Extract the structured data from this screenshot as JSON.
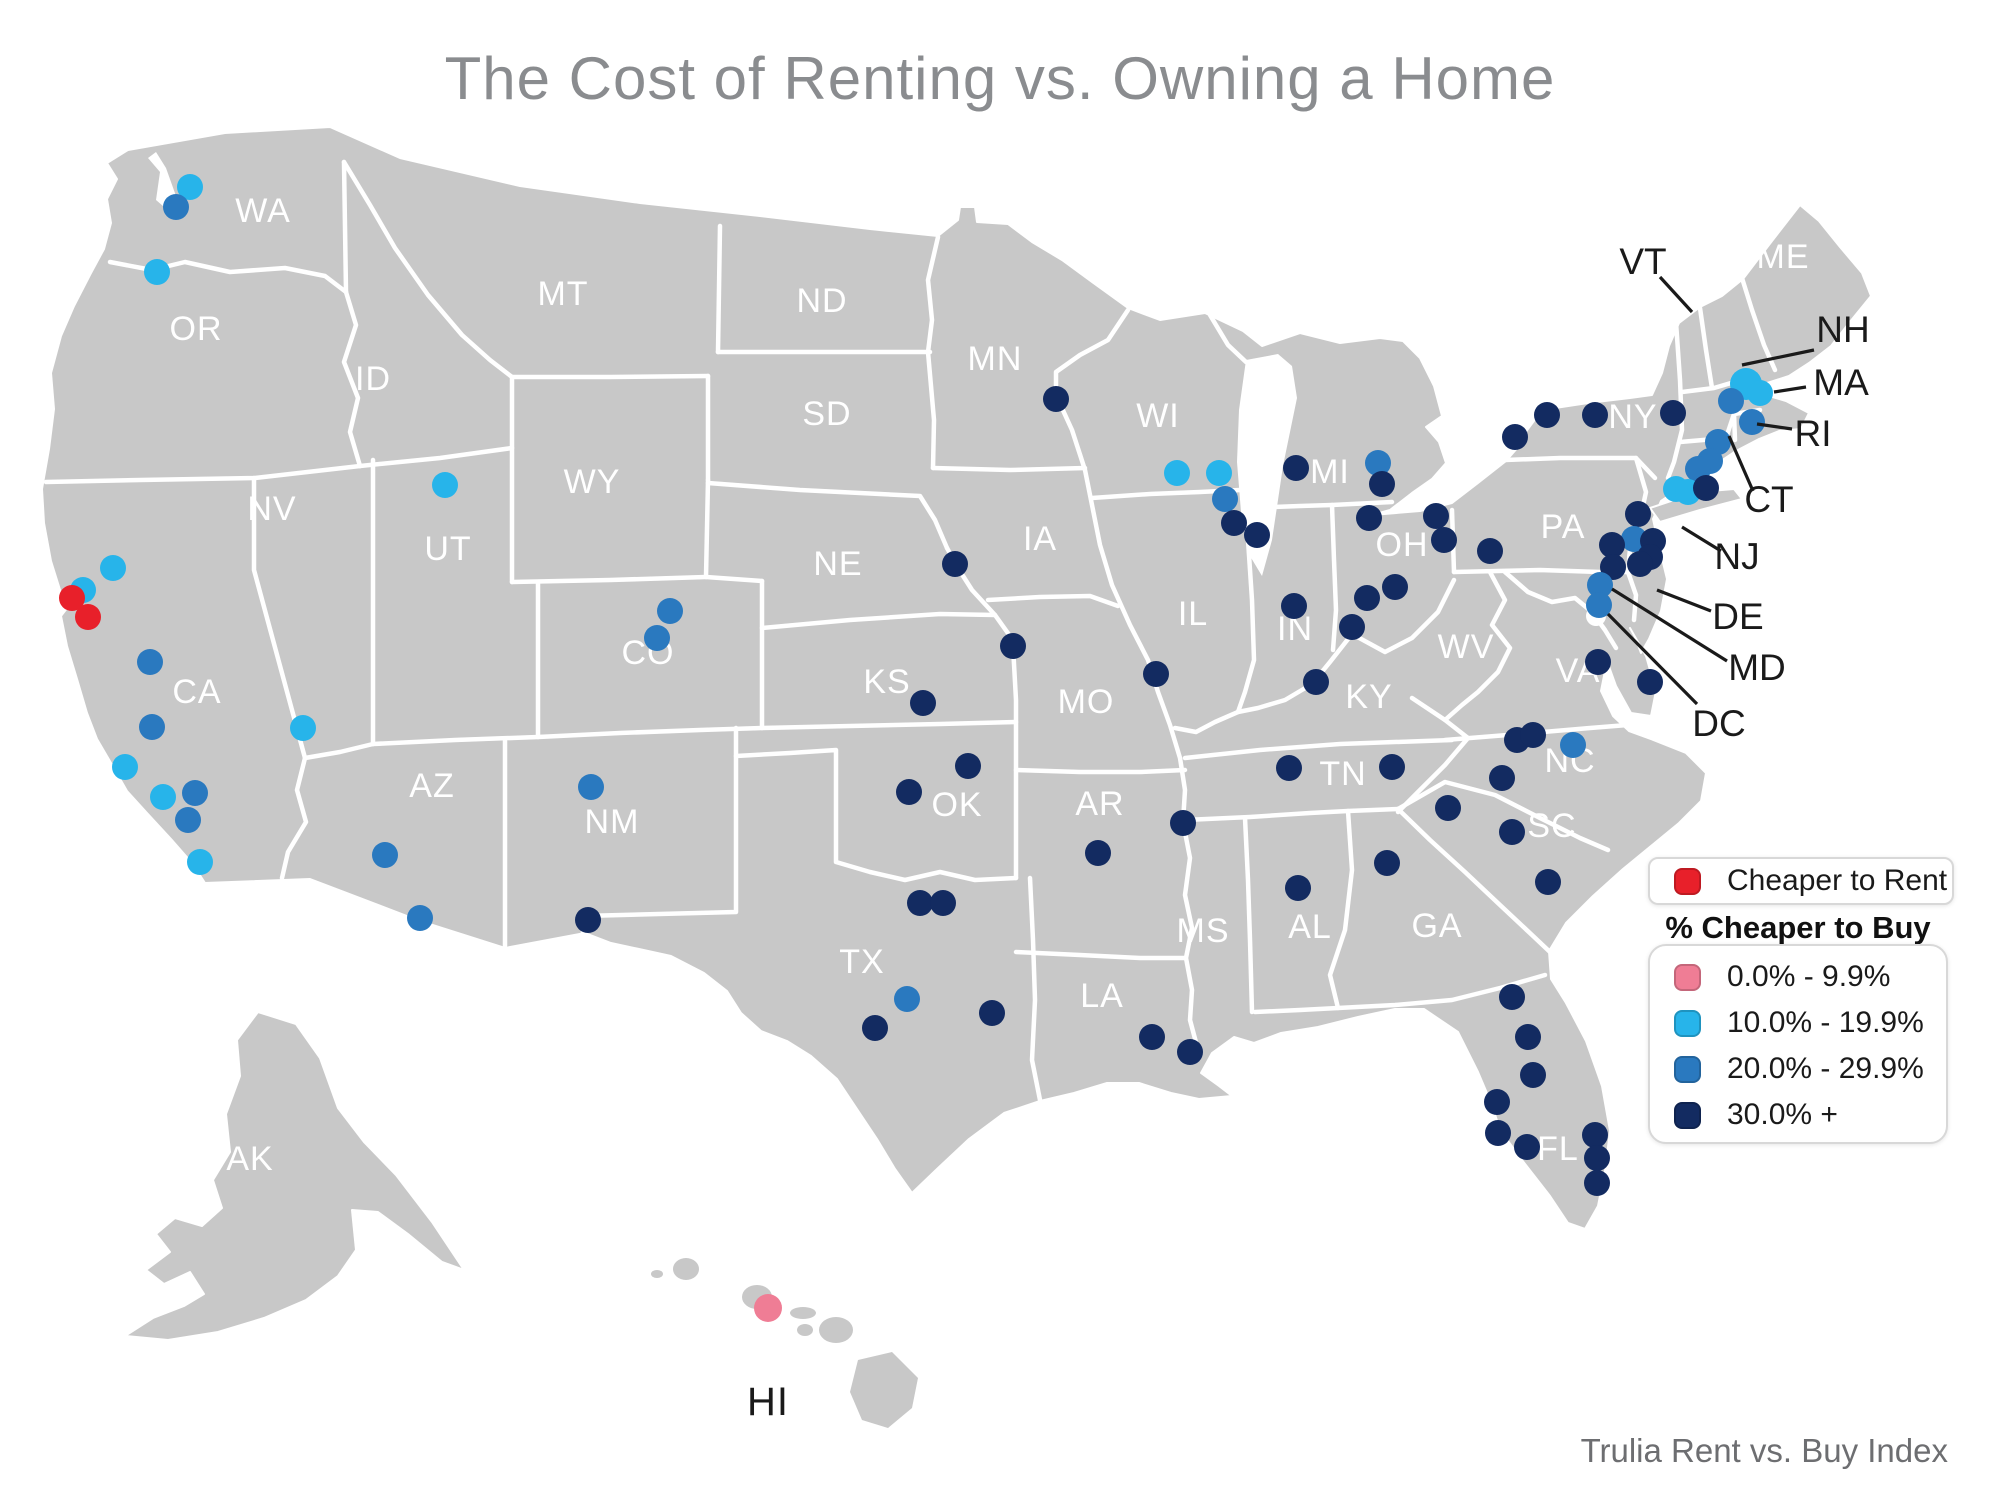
{
  "title": "The Cost of Renting vs. Owning a Home",
  "attribution": "Trulia Rent vs. Buy Index",
  "colors": {
    "rent": "#e8202a",
    "p0": "#ef7d95",
    "p10": "#27b4ea",
    "p20": "#2a79bf",
    "p30": "#132b61",
    "land": "#c8c8c8",
    "border": "#ffffff",
    "state_label": "#ffffff",
    "callout": "#1a1a1a",
    "title": "#8a8c8f",
    "attribution": "#6d6e71"
  },
  "legend": {
    "rent": {
      "label": "Cheaper to Rent",
      "color_key": "rent"
    },
    "buy_heading": "% Cheaper to Buy",
    "buy_items": [
      {
        "label": "0.0% - 9.9%",
        "color_key": "p0"
      },
      {
        "label": "10.0% - 19.9%",
        "color_key": "p10"
      },
      {
        "label": "20.0% - 29.9%",
        "color_key": "p20"
      },
      {
        "label": "30.0% +",
        "color_key": "p30"
      }
    ]
  },
  "chart_data": {
    "type": "scatter",
    "title": "The Cost of Renting vs. Owning a Home",
    "note": "Dot map of U.S. metros colored by Trulia Rent vs. Buy Index category",
    "categories": [
      "Cheaper to Rent",
      "0.0% - 9.9%",
      "10.0% - 19.9%",
      "20.0% - 29.9%",
      "30.0% +"
    ],
    "category_counts": {
      "cheaper_to_rent": 2,
      "buy_0_9.9": 1,
      "buy_10_19.9": 15,
      "buy_20_29.9": 22,
      "buy_30_plus": 61
    },
    "legend_position": "right"
  },
  "map": {
    "state_labels": [
      {
        "text": "WA",
        "x": 263,
        "y": 222
      },
      {
        "text": "OR",
        "x": 196,
        "y": 340
      },
      {
        "text": "CA",
        "x": 197,
        "y": 703
      },
      {
        "text": "NV",
        "x": 272,
        "y": 520
      },
      {
        "text": "ID",
        "x": 373,
        "y": 390
      },
      {
        "text": "UT",
        "x": 448,
        "y": 560
      },
      {
        "text": "AZ",
        "x": 432,
        "y": 797
      },
      {
        "text": "MT",
        "x": 563,
        "y": 305
      },
      {
        "text": "WY",
        "x": 592,
        "y": 493
      },
      {
        "text": "CO",
        "x": 648,
        "y": 664
      },
      {
        "text": "NM",
        "x": 612,
        "y": 833
      },
      {
        "text": "ND",
        "x": 822,
        "y": 312
      },
      {
        "text": "SD",
        "x": 827,
        "y": 425
      },
      {
        "text": "NE",
        "x": 838,
        "y": 575
      },
      {
        "text": "KS",
        "x": 887,
        "y": 693
      },
      {
        "text": "OK",
        "x": 957,
        "y": 816
      },
      {
        "text": "TX",
        "x": 862,
        "y": 973
      },
      {
        "text": "MN",
        "x": 995,
        "y": 370
      },
      {
        "text": "IA",
        "x": 1040,
        "y": 550
      },
      {
        "text": "MO",
        "x": 1086,
        "y": 713
      },
      {
        "text": "AR",
        "x": 1100,
        "y": 815
      },
      {
        "text": "LA",
        "x": 1102,
        "y": 1007
      },
      {
        "text": "WI",
        "x": 1158,
        "y": 427
      },
      {
        "text": "IL",
        "x": 1193,
        "y": 625
      },
      {
        "text": "IN",
        "x": 1295,
        "y": 640
      },
      {
        "text": "MI",
        "x": 1330,
        "y": 483
      },
      {
        "text": "OH",
        "x": 1402,
        "y": 556
      },
      {
        "text": "KY",
        "x": 1369,
        "y": 708
      },
      {
        "text": "TN",
        "x": 1343,
        "y": 785
      },
      {
        "text": "MS",
        "x": 1203,
        "y": 942
      },
      {
        "text": "AL",
        "x": 1310,
        "y": 938
      },
      {
        "text": "GA",
        "x": 1437,
        "y": 937
      },
      {
        "text": "FL",
        "x": 1558,
        "y": 1160
      },
      {
        "text": "WV",
        "x": 1466,
        "y": 658
      },
      {
        "text": "VA",
        "x": 1578,
        "y": 682
      },
      {
        "text": "NC",
        "x": 1570,
        "y": 772
      },
      {
        "text": "SC",
        "x": 1552,
        "y": 837
      },
      {
        "text": "PA",
        "x": 1563,
        "y": 538
      },
      {
        "text": "NY",
        "x": 1633,
        "y": 428
      },
      {
        "text": "ME",
        "x": 1783,
        "y": 268
      },
      {
        "text": "AK",
        "x": 250,
        "y": 1170
      },
      {
        "text": "HI",
        "x": 768,
        "y": 1415,
        "dark": true,
        "size": 40
      }
    ],
    "callouts": [
      {
        "text": "VT",
        "x": 1643,
        "y": 262,
        "line": [
          1660,
          277,
          1692,
          312
        ]
      },
      {
        "text": "NH",
        "x": 1843,
        "y": 330,
        "line": [
          1814,
          350,
          1742,
          365
        ]
      },
      {
        "text": "MA",
        "x": 1841,
        "y": 383,
        "line": [
          1806,
          387,
          1774,
          392
        ]
      },
      {
        "text": "RI",
        "x": 1813,
        "y": 434,
        "line": [
          1792,
          429,
          1757,
          424
        ]
      },
      {
        "text": "CT",
        "x": 1769,
        "y": 500,
        "line": [
          1753,
          491,
          1729,
          436
        ]
      },
      {
        "text": "NJ",
        "x": 1737,
        "y": 557,
        "line": [
          1721,
          551,
          1682,
          527
        ]
      },
      {
        "text": "DE",
        "x": 1738,
        "y": 617,
        "line": [
          1711,
          611,
          1657,
          590
        ]
      },
      {
        "text": "MD",
        "x": 1757,
        "y": 668,
        "line": [
          1727,
          661,
          1612,
          589
        ]
      },
      {
        "text": "DC",
        "x": 1719,
        "y": 724,
        "line": [
          1697,
          704,
          1608,
          614
        ]
      }
    ],
    "cities": [
      {
        "x": 190,
        "y": 187,
        "cat": "p10"
      },
      {
        "x": 176,
        "y": 207,
        "cat": "p20"
      },
      {
        "x": 157,
        "y": 272,
        "cat": "p10"
      },
      {
        "x": 445,
        "y": 485,
        "cat": "p10"
      },
      {
        "x": 113,
        "y": 568,
        "cat": "p10"
      },
      {
        "x": 83,
        "y": 590,
        "cat": "p10"
      },
      {
        "x": 72,
        "y": 598,
        "cat": "rent"
      },
      {
        "x": 88,
        "y": 617,
        "cat": "rent"
      },
      {
        "x": 150,
        "y": 662,
        "cat": "p20"
      },
      {
        "x": 152,
        "y": 727,
        "cat": "p20"
      },
      {
        "x": 125,
        "y": 767,
        "cat": "p10"
      },
      {
        "x": 163,
        "y": 797,
        "cat": "p10"
      },
      {
        "x": 195,
        "y": 793,
        "cat": "p20"
      },
      {
        "x": 188,
        "y": 820,
        "cat": "p20"
      },
      {
        "x": 200,
        "y": 862,
        "cat": "p10"
      },
      {
        "x": 303,
        "y": 728,
        "cat": "p10"
      },
      {
        "x": 385,
        "y": 855,
        "cat": "p20"
      },
      {
        "x": 420,
        "y": 918,
        "cat": "p20"
      },
      {
        "x": 591,
        "y": 787,
        "cat": "p20"
      },
      {
        "x": 588,
        "y": 920,
        "cat": "p30"
      },
      {
        "x": 670,
        "y": 611,
        "cat": "p20"
      },
      {
        "x": 657,
        "y": 638,
        "cat": "p20"
      },
      {
        "x": 1056,
        "y": 399,
        "cat": "p30"
      },
      {
        "x": 955,
        "y": 564,
        "cat": "p30"
      },
      {
        "x": 1013,
        "y": 646,
        "cat": "p30"
      },
      {
        "x": 923,
        "y": 703,
        "cat": "p30"
      },
      {
        "x": 1156,
        "y": 674,
        "cat": "p30"
      },
      {
        "x": 968,
        "y": 766,
        "cat": "p30"
      },
      {
        "x": 909,
        "y": 792,
        "cat": "p30"
      },
      {
        "x": 1183,
        "y": 823,
        "cat": "p30"
      },
      {
        "x": 1098,
        "y": 853,
        "cat": "p30"
      },
      {
        "x": 920,
        "y": 903,
        "cat": "p30"
      },
      {
        "x": 943,
        "y": 903,
        "cat": "p30"
      },
      {
        "x": 907,
        "y": 999,
        "cat": "p20"
      },
      {
        "x": 875,
        "y": 1028,
        "cat": "p30"
      },
      {
        "x": 992,
        "y": 1013,
        "cat": "p30"
      },
      {
        "x": 1152,
        "y": 1037,
        "cat": "p30"
      },
      {
        "x": 1190,
        "y": 1052,
        "cat": "p30"
      },
      {
        "x": 1177,
        "y": 473,
        "cat": "p10"
      },
      {
        "x": 1219,
        "y": 473,
        "cat": "p10"
      },
      {
        "x": 1225,
        "y": 499,
        "cat": "p20"
      },
      {
        "x": 1234,
        "y": 523,
        "cat": "p30"
      },
      {
        "x": 1257,
        "y": 535,
        "cat": "p30"
      },
      {
        "x": 1296,
        "y": 468,
        "cat": "p30"
      },
      {
        "x": 1378,
        "y": 463,
        "cat": "p20"
      },
      {
        "x": 1382,
        "y": 484,
        "cat": "p30"
      },
      {
        "x": 1369,
        "y": 518,
        "cat": "p30"
      },
      {
        "x": 1436,
        "y": 516,
        "cat": "p30"
      },
      {
        "x": 1444,
        "y": 540,
        "cat": "p30"
      },
      {
        "x": 1490,
        "y": 551,
        "cat": "p30"
      },
      {
        "x": 1395,
        "y": 587,
        "cat": "p30"
      },
      {
        "x": 1367,
        "y": 598,
        "cat": "p30"
      },
      {
        "x": 1352,
        "y": 627,
        "cat": "p30"
      },
      {
        "x": 1294,
        "y": 606,
        "cat": "p30"
      },
      {
        "x": 1316,
        "y": 682,
        "cat": "p30"
      },
      {
        "x": 1289,
        "y": 768,
        "cat": "p30"
      },
      {
        "x": 1392,
        "y": 767,
        "cat": "p30"
      },
      {
        "x": 1387,
        "y": 863,
        "cat": "p30"
      },
      {
        "x": 1298,
        "y": 888,
        "cat": "p30"
      },
      {
        "x": 1448,
        "y": 808,
        "cat": "p30"
      },
      {
        "x": 1512,
        "y": 832,
        "cat": "p30"
      },
      {
        "x": 1548,
        "y": 882,
        "cat": "p30"
      },
      {
        "x": 1502,
        "y": 778,
        "cat": "p30"
      },
      {
        "x": 1517,
        "y": 740,
        "cat": "p30"
      },
      {
        "x": 1533,
        "y": 735,
        "cat": "p30"
      },
      {
        "x": 1573,
        "y": 745,
        "cat": "p20"
      },
      {
        "x": 1598,
        "y": 662,
        "cat": "p30"
      },
      {
        "x": 1650,
        "y": 682,
        "cat": "p30"
      },
      {
        "x": 1512,
        "y": 997,
        "cat": "p30"
      },
      {
        "x": 1528,
        "y": 1037,
        "cat": "p30"
      },
      {
        "x": 1533,
        "y": 1075,
        "cat": "p30"
      },
      {
        "x": 1497,
        "y": 1102,
        "cat": "p30"
      },
      {
        "x": 1498,
        "y": 1133,
        "cat": "p30"
      },
      {
        "x": 1527,
        "y": 1147,
        "cat": "p30"
      },
      {
        "x": 1595,
        "y": 1135,
        "cat": "p30"
      },
      {
        "x": 1597,
        "y": 1158,
        "cat": "p30"
      },
      {
        "x": 1597,
        "y": 1183,
        "cat": "p30"
      },
      {
        "x": 1515,
        "y": 437,
        "cat": "p30"
      },
      {
        "x": 1547,
        "y": 415,
        "cat": "p30"
      },
      {
        "x": 1595,
        "y": 415,
        "cat": "p30"
      },
      {
        "x": 1673,
        "y": 413,
        "cat": "p30"
      },
      {
        "x": 1746,
        "y": 384,
        "cat": "p10",
        "r": 16
      },
      {
        "x": 1760,
        "y": 393,
        "cat": "p10"
      },
      {
        "x": 1731,
        "y": 401,
        "cat": "p20"
      },
      {
        "x": 1752,
        "y": 422,
        "cat": "p20"
      },
      {
        "x": 1718,
        "y": 442,
        "cat": "p20"
      },
      {
        "x": 1710,
        "y": 461,
        "cat": "p20"
      },
      {
        "x": 1698,
        "y": 469,
        "cat": "p20"
      },
      {
        "x": 1676,
        "y": 489,
        "cat": "p10"
      },
      {
        "x": 1688,
        "y": 492,
        "cat": "p10"
      },
      {
        "x": 1706,
        "y": 488,
        "cat": "p30"
      },
      {
        "x": 1638,
        "y": 514,
        "cat": "p30"
      },
      {
        "x": 1634,
        "y": 539,
        "cat": "p20"
      },
      {
        "x": 1653,
        "y": 541,
        "cat": "p30"
      },
      {
        "x": 1650,
        "y": 557,
        "cat": "p30"
      },
      {
        "x": 1640,
        "y": 564,
        "cat": "p30"
      },
      {
        "x": 1612,
        "y": 545,
        "cat": "p30"
      },
      {
        "x": 1613,
        "y": 567,
        "cat": "p30"
      },
      {
        "x": 1600,
        "y": 585,
        "cat": "p20"
      },
      {
        "x": 1599,
        "y": 605,
        "cat": "p20"
      },
      {
        "x": 768,
        "y": 1308,
        "cat": "p0",
        "r": 14
      }
    ]
  }
}
